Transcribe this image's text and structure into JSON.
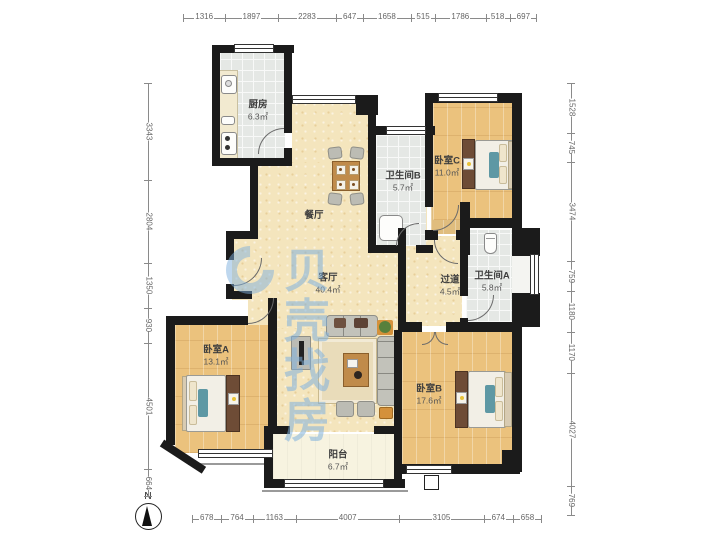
{
  "watermark": {
    "brand": "贝壳找房"
  },
  "compass": {
    "north_label": "N"
  },
  "rooms": {
    "kitchen": {
      "name": "厨房",
      "area": "6.3㎡"
    },
    "dining": {
      "name": "餐厅",
      "area": ""
    },
    "bathroom_b": {
      "name": "卫生间B",
      "area": "5.7㎡"
    },
    "bedroom_c": {
      "name": "卧室C",
      "area": "11.0㎡"
    },
    "living": {
      "name": "客厅",
      "area": "40.4㎡"
    },
    "hallway": {
      "name": "过道",
      "area": "4.5㎡"
    },
    "bathroom_a": {
      "name": "卫生间A",
      "area": "5.8㎡"
    },
    "bedroom_a": {
      "name": "卧室A",
      "area": "13.1㎡"
    },
    "bedroom_b": {
      "name": "卧室B",
      "area": "17.6㎡"
    },
    "balcony": {
      "name": "阳台",
      "area": "6.7㎡"
    }
  },
  "rulers": {
    "top": [
      1316,
      1897,
      2283,
      647,
      1658,
      515,
      1786,
      518,
      697
    ],
    "left": [
      3343,
      2804,
      1350,
      930,
      4501,
      664
    ],
    "right": [
      1528,
      745,
      3474,
      759,
      1180,
      1170,
      4027,
      769
    ],
    "bottom": [
      678,
      764,
      1163,
      4007,
      3105,
      674,
      658
    ]
  },
  "colors": {
    "wall": "#1b1b1b",
    "floor_main": "#f4e5bd",
    "floor_wood": "#ebc27d",
    "floor_tile": "#e5e8e5",
    "floor_balcony": "#f7f3e0",
    "watermark_blue": "#7fb0dd",
    "accent_teal": "#5e98a4",
    "accent_orange": "#d4913b"
  }
}
